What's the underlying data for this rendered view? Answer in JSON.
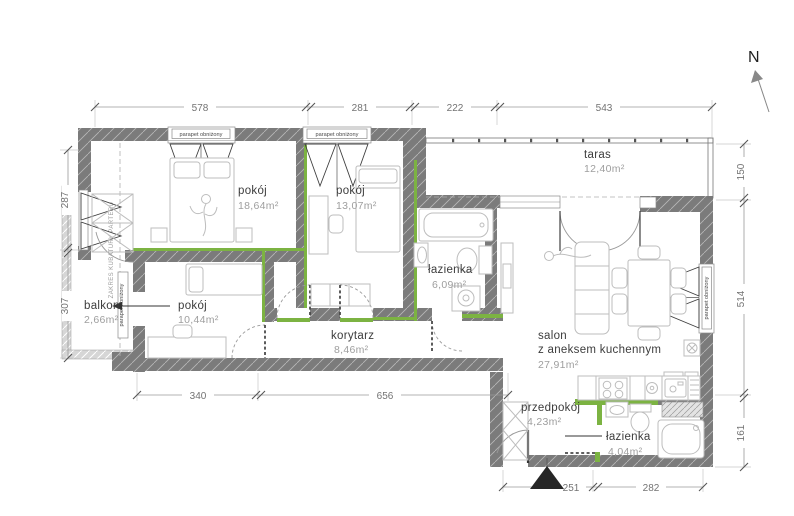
{
  "plan": {
    "north": "N",
    "window_label": "parapet obniżony",
    "boundary_label": "ZAKRES KUBATURY PARTERU",
    "rooms": {
      "room1": {
        "name": "pokój",
        "area": "18,64m²"
      },
      "room2": {
        "name": "pokój",
        "area": "13,07m²"
      },
      "taras": {
        "name": "taras",
        "area": "12,40m²"
      },
      "balkon": {
        "name": "balkon",
        "area": "2,66m²"
      },
      "room3": {
        "name": "pokój",
        "area": "10,44m²"
      },
      "bath1": {
        "name": "łazienka",
        "area": "6,09m²"
      },
      "corridor": {
        "name": "korytarz",
        "area": "8,46m²"
      },
      "salon": {
        "name_line1": "salon",
        "name_line2": "z aneksem kuchennym",
        "area": "27,91m²"
      },
      "hall": {
        "name": "przedpokój",
        "area": "4,23m²"
      },
      "bath2": {
        "name": "łazienka",
        "area": "4,04m²"
      }
    },
    "dims": {
      "top": [
        "578",
        "281",
        "222",
        "543"
      ],
      "left": [
        "287",
        "307"
      ],
      "right": [
        "150",
        "514",
        "161"
      ],
      "inner": [
        "340",
        "656"
      ],
      "bottom": [
        "251",
        "282"
      ]
    },
    "colors": {
      "wall": "#7b7b7b",
      "accent_green": "#7cb342",
      "entrance_marker": "#262626"
    }
  }
}
